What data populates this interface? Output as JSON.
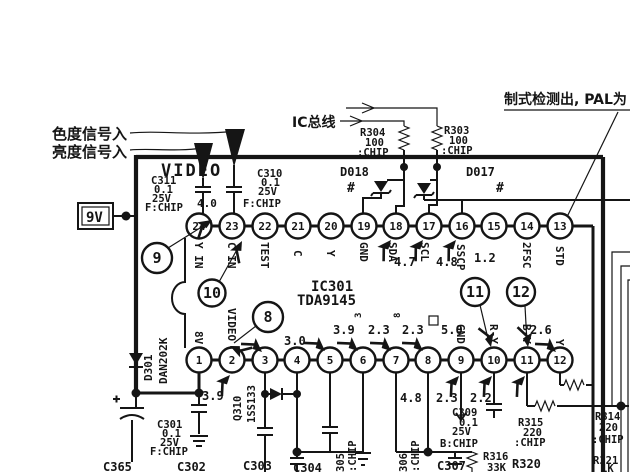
{
  "annotations": {
    "chroma_in": "色度信号入",
    "luma_in": "亮度信号入",
    "ic_bus": "IC总线",
    "std_note": "制式检测出, PAL为",
    "supply_9v": "9V",
    "video_label": "VIDEO",
    "hash_left": "#",
    "hash_right": "#",
    "mark_3": "3",
    "mark_8": "8",
    "cap_value_mid": "4.0"
  },
  "ic": {
    "ref": "IC301",
    "part": "TDA9145",
    "top_pins": [
      {
        "n": "24",
        "label": "Y IN"
      },
      {
        "n": "23",
        "label": "C IN"
      },
      {
        "n": "22",
        "label": "TEST"
      },
      {
        "n": "21",
        "label": "C"
      },
      {
        "n": "20",
        "label": "Y"
      },
      {
        "n": "19",
        "label": "GND"
      },
      {
        "n": "18",
        "label": "SDA",
        "v": "4.7"
      },
      {
        "n": "17",
        "label": "SCL",
        "v": "4.8"
      },
      {
        "n": "16",
        "label": "SSCP",
        "v": "1.2"
      },
      {
        "n": "15",
        "label": ""
      },
      {
        "n": "14",
        "label": "2FSC"
      },
      {
        "n": "13",
        "label": "STD"
      }
    ],
    "bottom_pins": [
      {
        "n": "1",
        "label": "8V",
        "v": "3.9"
      },
      {
        "n": "2",
        "label": "VIDEO"
      },
      {
        "n": "3",
        "label": "",
        "v": "3.0"
      },
      {
        "n": "4",
        "label": ""
      },
      {
        "n": "5",
        "label": "",
        "v": "3.9"
      },
      {
        "n": "6",
        "label": "",
        "v": "2.3"
      },
      {
        "n": "7",
        "label": "",
        "v": "2.3"
      },
      {
        "n": "8",
        "label": "",
        "v": "5.0"
      },
      {
        "n": "9",
        "label": "GND",
        "v": "4.8"
      },
      {
        "n": "10",
        "label": "R-Y",
        "v": "2.3"
      },
      {
        "n": "11",
        "label": "B-Y",
        "v": "2.2"
      },
      {
        "n": "12",
        "label": "Y",
        "v": "2.6"
      }
    ],
    "callouts": [
      "9",
      "10",
      "8",
      "11",
      "12"
    ]
  },
  "components": {
    "c311": {
      "ref": "C311",
      "value": "0.1",
      "volt": "25V",
      "type": "F:CHIP"
    },
    "c310": {
      "ref": "C310",
      "value": "0.1",
      "volt": "25V",
      "type": "F:CHIP"
    },
    "r304": {
      "ref": "R304",
      "value": "100",
      "type": ":CHIP"
    },
    "r303": {
      "ref": "R303",
      "value": "100",
      "type": ":CHIP"
    },
    "d018": {
      "ref": "D018"
    },
    "d017": {
      "ref": "D017"
    },
    "d301": {
      "ref": "D301",
      "part": "DAN202K"
    },
    "d310": {
      "ref": "Q310",
      "part": "1SS133"
    },
    "c365": {
      "ref": "C365"
    },
    "c301": {
      "ref": "C301",
      "value": "0.1",
      "volt": "25V",
      "type": "F:CHIP"
    },
    "c302": {
      "ref": "C302"
    },
    "c303": {
      "ref": "C303"
    },
    "c304": {
      "ref": "C304"
    },
    "c305": {
      "ref": "305",
      "type": ":CHIP"
    },
    "c306": {
      "ref": "306",
      "type": ":CHIP"
    },
    "c307": {
      "ref": "C307"
    },
    "c309": {
      "ref": "C309",
      "value": "0.1",
      "volt": "25V",
      "type": "B:CHIP"
    },
    "r315": {
      "ref": "R315",
      "value": "220",
      "type": ":CHIP"
    },
    "r316": {
      "ref": "R316",
      "value": "33K"
    },
    "r320": {
      "ref": "R320"
    },
    "r314": {
      "ref": "R314",
      "value": "220",
      "type": ":CHIP"
    },
    "r321": {
      "ref": "R321",
      "value": "1K"
    }
  }
}
